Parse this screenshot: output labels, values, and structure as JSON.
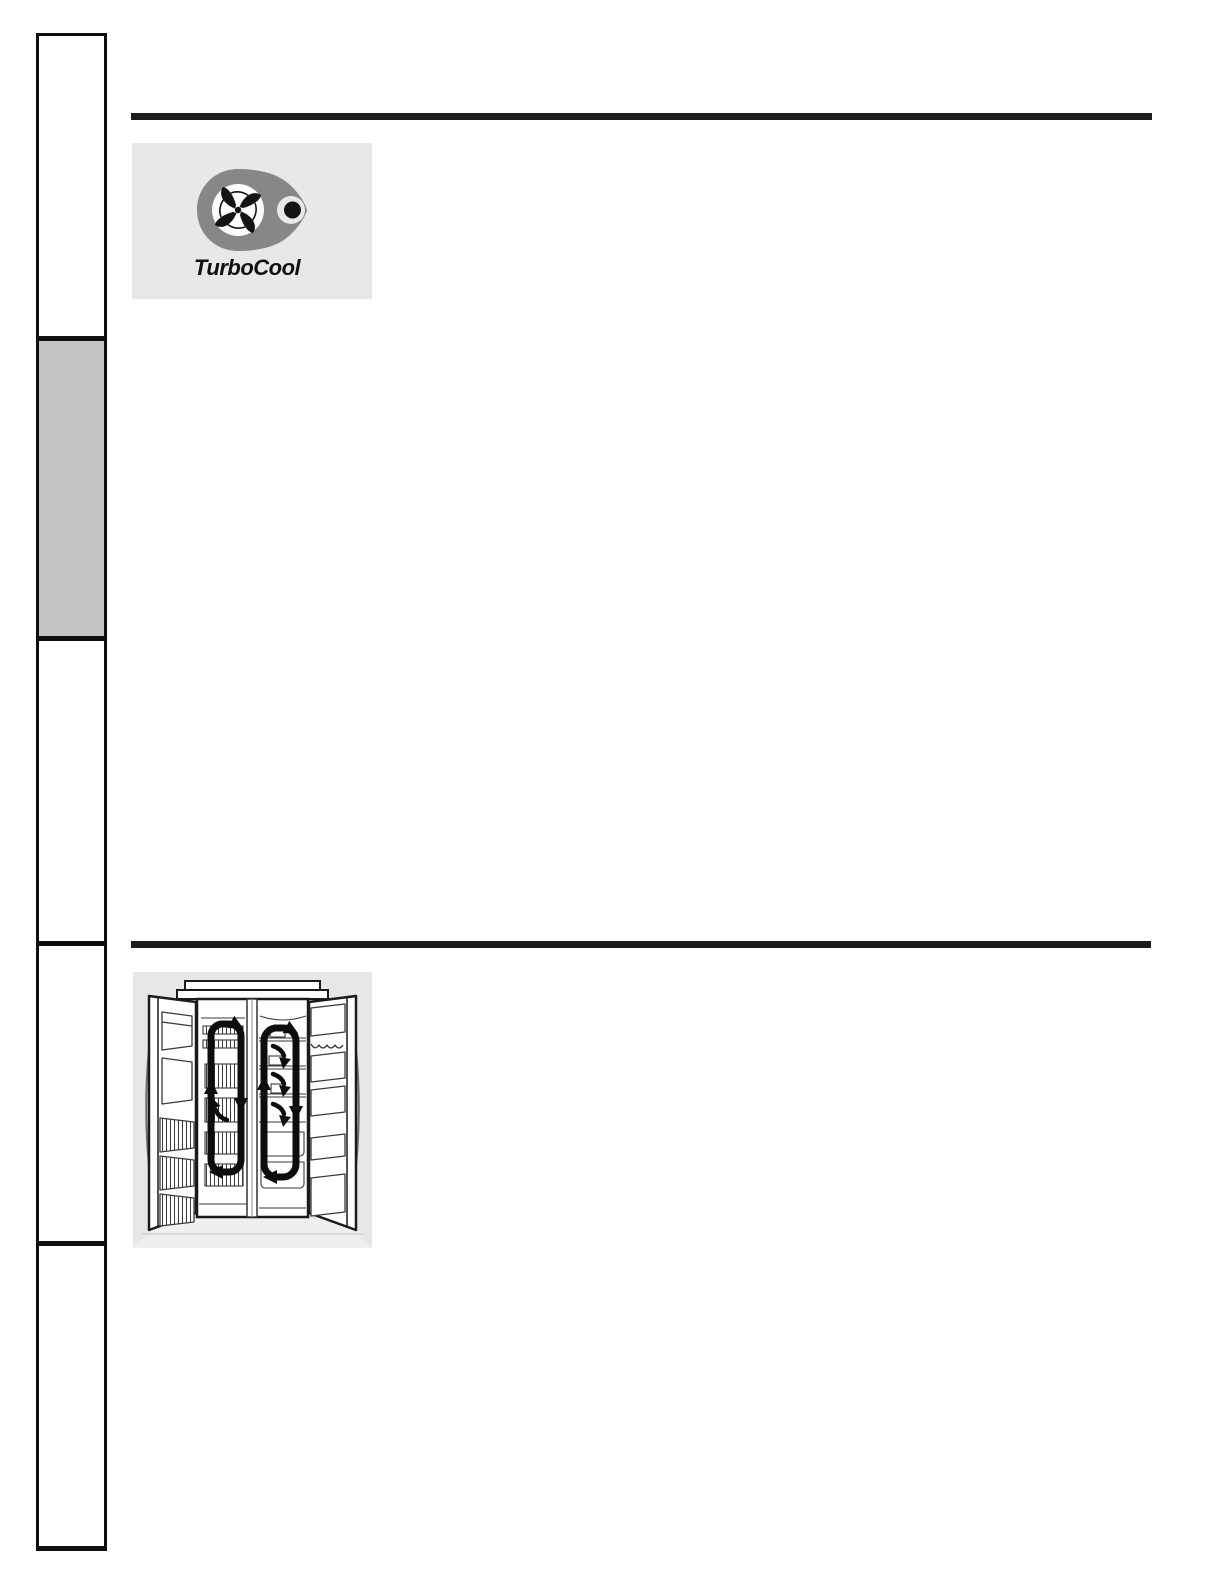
{
  "page": {
    "kind": "appliance-manual-page",
    "background": "#ffffff"
  },
  "sidebar_tabs": [
    {
      "id": "tab-1",
      "fill": "#ffffff"
    },
    {
      "id": "tab-2",
      "fill": "#c3c3c3"
    },
    {
      "id": "tab-3",
      "fill": "#ffffff"
    },
    {
      "id": "tab-4",
      "fill": "#ffffff"
    },
    {
      "id": "tab-5",
      "fill": "#ffffff"
    }
  ],
  "rules": {
    "color": "#1d1d1d"
  },
  "logo_panel": {
    "background": "#e8e8e8",
    "icon": "turbocool-fan-icon",
    "wordmark": "TurboCool",
    "ring_color": "#878787",
    "dot_color": "#141414",
    "fan_color": "#141414"
  },
  "diagram_panel": {
    "background": "#e7e7e7",
    "icon": "refrigerator-airflow-diagram",
    "line_color": "#1a1a1a",
    "airflow_arrow_color": "#0d0d0d"
  }
}
